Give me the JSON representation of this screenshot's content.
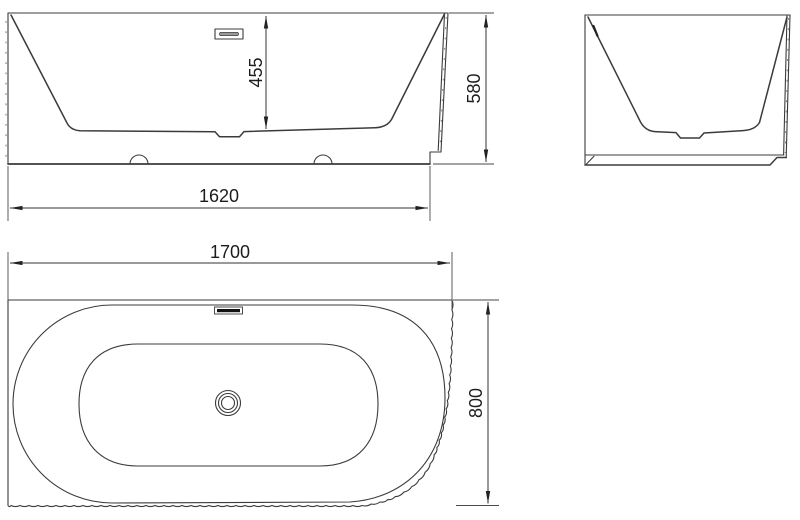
{
  "colors": {
    "background": "#ffffff",
    "line": "#3b3b3b",
    "text": "#1c1c1c",
    "overflow_fill": "#111111"
  },
  "dimensions": {
    "front_view": {
      "basin_depth": "455",
      "overall_height": "580",
      "base_length": "1620"
    },
    "plan_view": {
      "overall_length": "1700",
      "overall_width": "800"
    }
  }
}
